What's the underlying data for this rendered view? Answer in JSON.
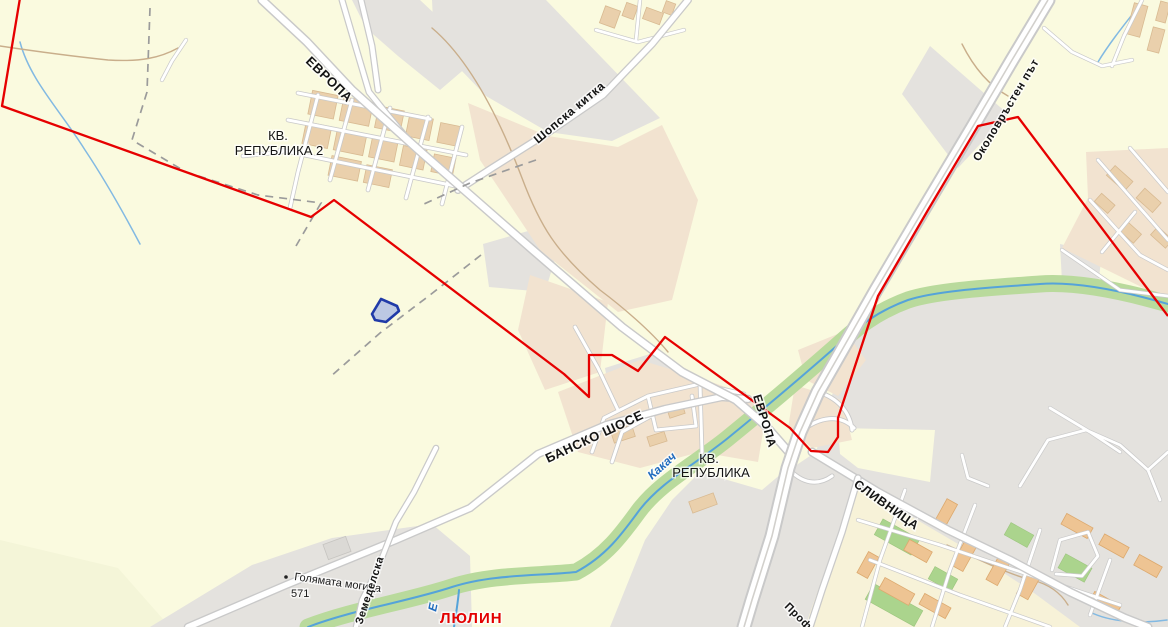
{
  "map": {
    "type": "street-map",
    "labels": {
      "evropa_nw": "ЕВРОПА",
      "kv_republika2_line1": "КВ.",
      "kv_republika2_line2": "РЕПУБЛИКА 2",
      "shopska_kitka": "Шопска китка",
      "okolovrasten_pat": "Околовръстен път",
      "evropa_s": "ЕВРОПА",
      "bansko_shose": "БАНСКО ШОСЕ",
      "kakach": "Какач",
      "kv_republika_line1": "КВ.",
      "kv_republika_line2": "РЕПУБЛИКА",
      "slivnitsa": "СЛИВНИЦА",
      "golyamata_mogila": "Голямата могила",
      "elevation": "571",
      "zemedelska": "Земеделска",
      "lyulin": "ЛЮЛИН",
      "prof": "Проф",
      "river_letter": "Е"
    },
    "colors": {
      "field": "#FAFADF",
      "urban": "#E4E2DE",
      "industrial": "#F2E3D0",
      "building": "#EAD0AC",
      "building_orange": "#EEC493",
      "courtyard_green": "#ABD48D",
      "road_fill": "#FFFFFF",
      "road_casing": "#C9C9C9",
      "river_band": "#B9DA9C",
      "stream": "#55A3D9",
      "boundary_red": "#E60000",
      "parcel_blue": "#203AA8",
      "water_label": "#1F6BBF",
      "district_red": "#E30000",
      "dashed_gray": "#9B9B9B"
    }
  }
}
